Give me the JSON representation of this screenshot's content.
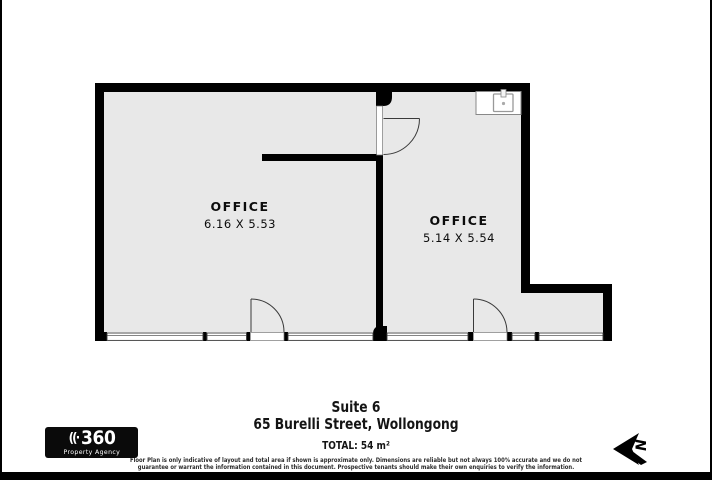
{
  "plan": {
    "rooms": [
      {
        "label": "OFFICE",
        "dimensions": "6.16 X 5.53"
      },
      {
        "label": "OFFICE",
        "dimensions": "5.14 X 5.54"
      }
    ]
  },
  "footer": {
    "suite": "Suite 6",
    "address": "65 Burelli Street, Wollongong",
    "total": "TOTAL: 54 m²",
    "disclaimer_line1": "Floor Plan is only indicative of layout and total area if shown is approximate only. Dimensions are reliable but not always 100% accurate and we do not",
    "disclaimer_line2": "guarantee or warrant the information contained in this document. Prospective tenants should make their own enquiries to verify the information."
  },
  "logo": {
    "arcs_icon": "((·",
    "number": "360",
    "subtitle": "Property Agency"
  },
  "compass": {
    "label": "N"
  },
  "colors": {
    "background": "#ffffff",
    "wall": "#000000",
    "floor": "#e8e8e8",
    "line": "#3a3a3a",
    "bar": "#000000"
  }
}
